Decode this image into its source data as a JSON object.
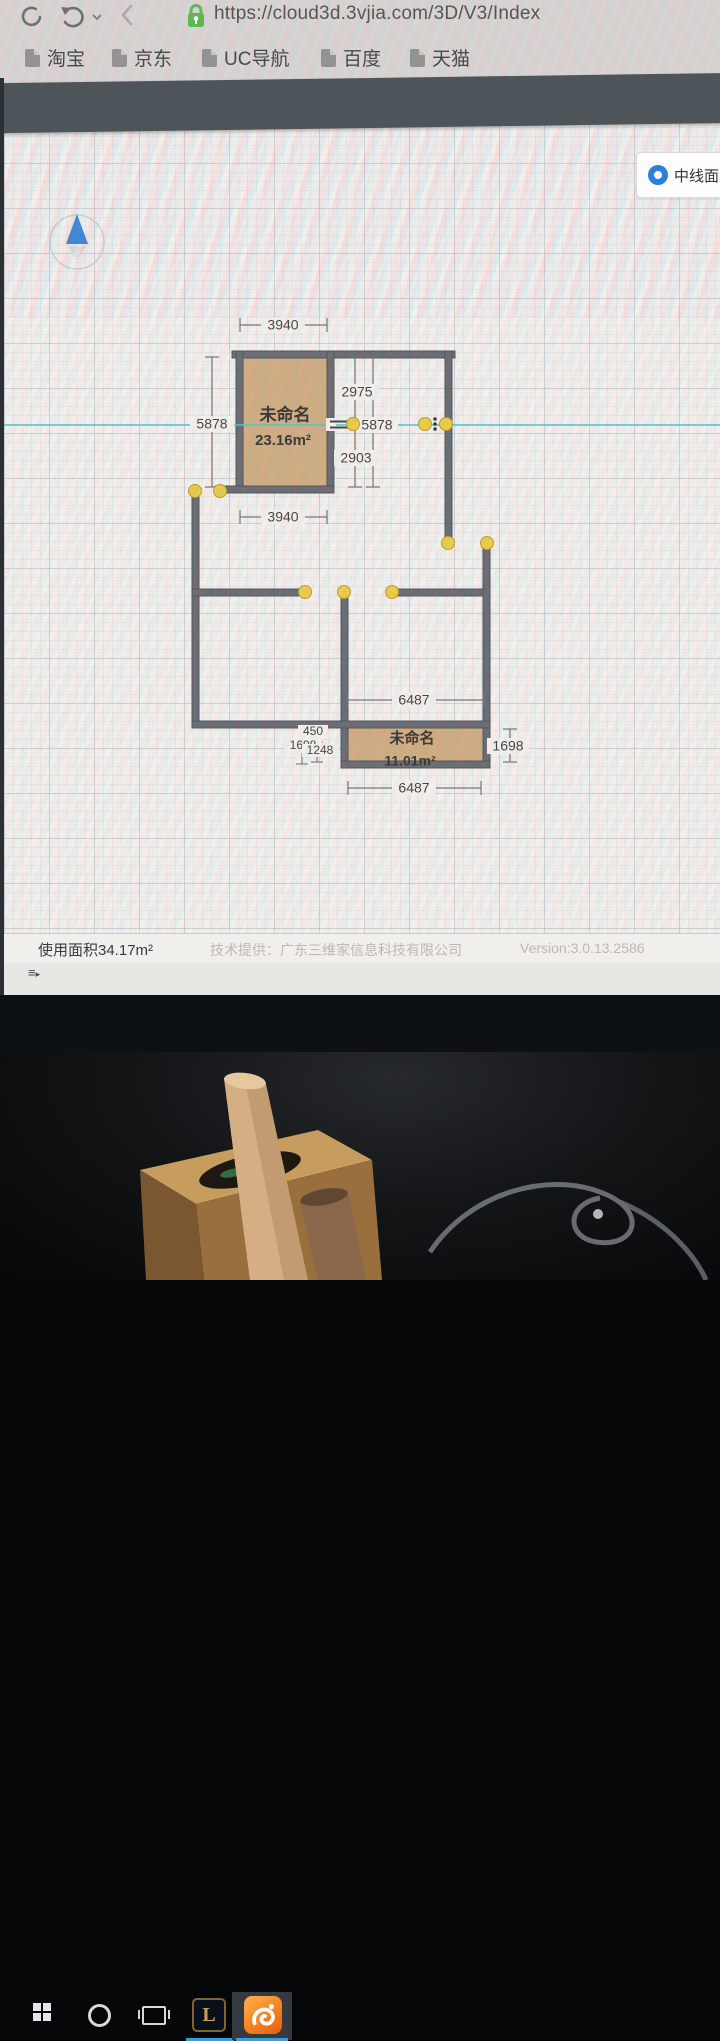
{
  "browser": {
    "url": "https://cloud3d.3vjia.com/3D/V3/Index",
    "bookmarks": [
      "淘宝",
      "京东",
      "UC导航",
      "百度",
      "天猫"
    ]
  },
  "panel": {
    "radio_label": "中线面"
  },
  "floorplan": {
    "rooms": [
      {
        "name": "未命名",
        "area": "23.16m²"
      },
      {
        "name": "未命名",
        "area": "11.01m²"
      }
    ],
    "dims": {
      "top_width": "3940",
      "left_height": "5878",
      "mid_upper": "2975",
      "mid_total": "5878",
      "mid_lower": "2903",
      "bottom_width": "3940",
      "lower_top": "6487",
      "lower_bottom": "6487",
      "small_a": "450",
      "small_b": "1698",
      "small_c": "1248",
      "right_height": "1698"
    }
  },
  "statusbar": {
    "used_area": "使用面积34.17m²",
    "provider": "技术提供：广东三维家信息科技有限公司",
    "version": "Version:3.0.13.2586"
  },
  "icons": {
    "nav": [
      "reload-icon",
      "back-icon",
      "forward-icon",
      "lock-icon"
    ],
    "canvas": [
      "north-arrow-icon",
      "vertex-handle",
      "wall-split-icon",
      "wall-dots-icon"
    ],
    "taskbar": [
      "windows-start-icon",
      "cortana-icon",
      "task-view-icon",
      "league-of-legends-icon",
      "uc-browser-icon"
    ]
  },
  "colors": {
    "accent_blue": "#2a7fe0",
    "wall": "#63676d",
    "room_fill": "#cdab7d",
    "handle_yellow": "#e9cb42",
    "guide_cyan": "#3fc9c4",
    "taskbar_underline": "#3f9bd8",
    "uc_orange": "#f5831f",
    "lock_green": "#55b848"
  }
}
